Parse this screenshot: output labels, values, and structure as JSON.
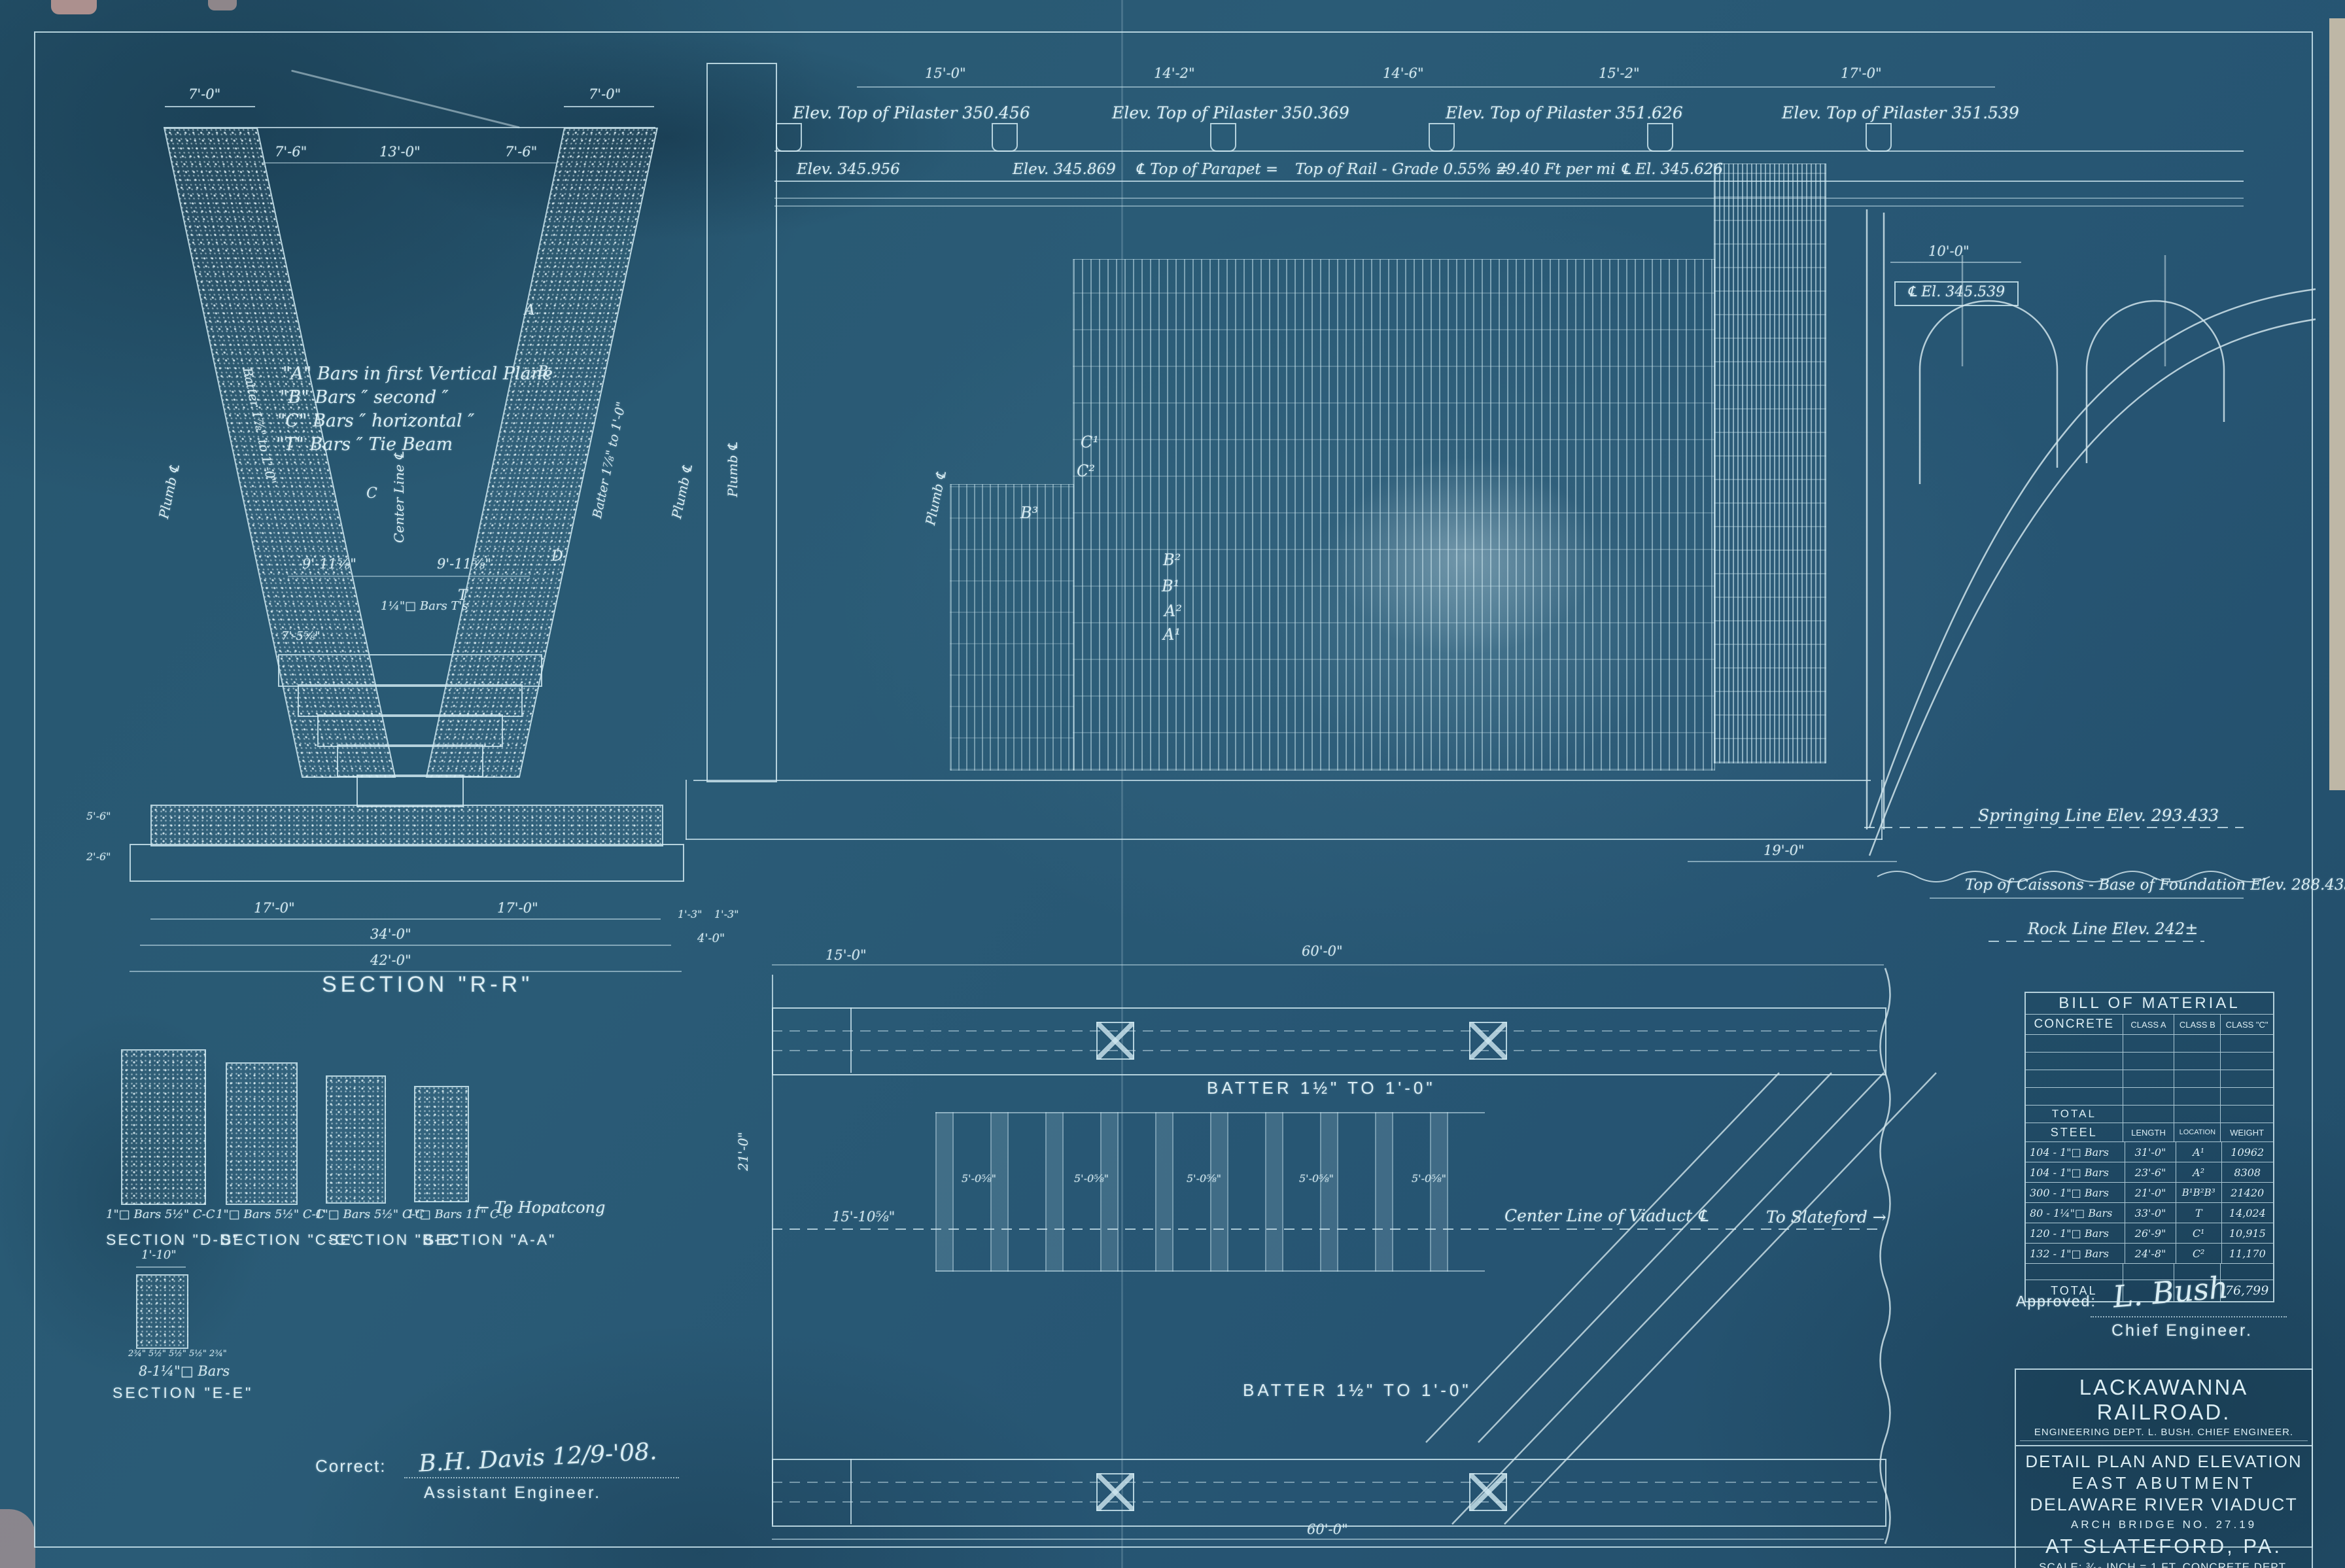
{
  "section_rr": {
    "title": "SECTION \"R-R\"",
    "notes": [
      "\"A\" Bars in first Vertical Plane",
      "\"B\" Bars  ″ second  ″",
      "\"C\" Bars  ″ horizontal  ″",
      "\"T\" Bars  ″ Tie Beam"
    ],
    "dims": {
      "leg_top_left": "7'-0\"",
      "leg_top_right": "7'-0\"",
      "top_inner": [
        "7'-6\"",
        "13'-0\"",
        "7'-6\""
      ],
      "mid": [
        "9'-11⅝\"",
        "9'-11⅝\""
      ],
      "mid_note": "1¼\"□ Bars  T's",
      "mid_left": "7'-5⅝\"",
      "bottom": [
        "17'-0\"",
        "17'-0\"",
        "34'-0\"",
        "42'-0\""
      ],
      "base_left": [
        "5'-6\"",
        "2'-6\""
      ],
      "base_right": [
        "1'-3\"",
        "1'-3\"",
        "4'-0\""
      ]
    },
    "leg_note": "Batter 1⅞\" to 1'-0\"",
    "center_note": "Center Line ℄",
    "plumb_note": "Plumb ℄",
    "callouts": [
      "A",
      "B",
      "C",
      "D",
      "T"
    ]
  },
  "elevation": {
    "top_dims": [
      "15'-0\"",
      "14'-2\"",
      "14'-6\"",
      "15'-2\"",
      "17'-0\""
    ],
    "pilasters": [
      "Elev. Top of Pilaster 350.456",
      "Elev. Top of Pilaster 350.369",
      "Elev. Top of Pilaster 351.626",
      "Elev. Top of Pilaster 351.539"
    ],
    "rail_labels": [
      "Elev. 345.956",
      "Elev. 345.869",
      "℄ Top of Parapet =",
      "Top of Rail - Grade 0.55% =",
      "29.40 Ft per mi",
      "℄ El. 345.626",
      "℄ El. 345.539"
    ],
    "dim_10": "10'-0\"",
    "springing": "Springing Line Elev. 293.433",
    "caissons": "Top of Caissons - Base of Foundation  Elev. 288.433",
    "rock": "Rock Line Elev. 242±",
    "dim_19": "19'-0\"",
    "dim_4": "4'-0\"",
    "dims_13": [
      "1'-3\"",
      "1'-3\""
    ],
    "plumb": "Plumb ℄",
    "callouts": [
      "C¹",
      "C²",
      "B³",
      "B²",
      "B¹",
      "A²",
      "A¹"
    ]
  },
  "plan": {
    "batter_top": "BATTER   1½\" TO 1'-0\"",
    "batter_bottom": "BATTER   1½\" TO 1'-0\"",
    "center_line": "Center Line of Viaduct ℄",
    "to_slateford": "To Slateford →",
    "to_hopatcong": "← To Hopatcong",
    "dim_60_top": "60'-0\"",
    "dim_60_bottom": "60'-0\"",
    "dim_15": "15'-0\"",
    "dim_1510": "15'-10⅝\"",
    "bar_spacing": "5'-0⅝\"",
    "dim_21": "21'-0\""
  },
  "sections_small": {
    "items": [
      {
        "label": "SECTION \"D-D\"",
        "bars": "1\"□ Bars 5½\" C-C"
      },
      {
        "label": "SECTION \"C-C\"",
        "bars": "1\"□ Bars 5½\" C-C"
      },
      {
        "label": "SECTION \"B-B\"",
        "bars": "1\"□ Bars 5½\" C-C"
      },
      {
        "label": "SECTION \"A-A\"",
        "bars": "1\"□ Bars 11\" C-C"
      }
    ],
    "section_ee": {
      "label": "SECTION \"E-E\"",
      "bars": "8-1¼\"□ Bars",
      "dim_top": "1'-10\"",
      "dims_bottom": "2¾\" 5½\" 5½\" 5½\" 2¾\""
    }
  },
  "bom": {
    "title": "BILL OF MATERIAL",
    "concrete": {
      "col0": "CONCRETE",
      "cols": [
        "CLASS A",
        "CLASS B",
        "CLASS \"C\""
      ],
      "total_label": "TOTAL"
    },
    "steel": {
      "headers": [
        "STEEL",
        "LENGTH",
        "LOCATION",
        "WEIGHT"
      ],
      "rows": [
        [
          "104 - 1\"□ Bars",
          "31'-0\"",
          "A¹",
          "10962"
        ],
        [
          "104 - 1\"□ Bars",
          "23'-6\"",
          "A²",
          "8308"
        ],
        [
          "300 - 1\"□ Bars",
          "21'-0\"",
          "B¹B²B³",
          "21420"
        ],
        [
          "80 - 1¼\"□ Bars",
          "33'-0\"",
          "T",
          "14,024"
        ],
        [
          "120 - 1\"□ Bars",
          "26'-9\"",
          "C¹",
          "10,915"
        ],
        [
          "132 - 1\"□ Bars",
          "24'-8\"",
          "C²",
          "11,170"
        ]
      ],
      "total_label": "TOTAL",
      "total": "76,799"
    }
  },
  "approval": {
    "label": "Approved:",
    "signature": "L. Bush",
    "role": "Chief Engineer."
  },
  "correct": {
    "label": "Correct:",
    "signature": "B.H. Davis  12/9-'08.",
    "role": "Assistant Engineer."
  },
  "titleblock": {
    "company": "LACKAWANNA RAILROAD.",
    "dept": "ENGINEERING DEPT.   L. BUSH. CHIEF ENGINEER.",
    "title1": "DETAIL PLAN AND ELEVATION",
    "title2": "EAST ABUTMENT",
    "title3": "DELAWARE RIVER VIADUCT",
    "bridge": "ARCH BRIDGE NO. 27.19",
    "location": "AT SLATEFORD, PA.",
    "scale": "SCALE: ³⁄₁₆ INCH = 1 FT.   CONCRETE DEPT.",
    "credits": "Designed A.B.C. Traced A.B.C. Checked.",
    "sheet": "Sheet 7 of 24 Sheets. Hoboken, N.J. Dec. 8.1908."
  }
}
